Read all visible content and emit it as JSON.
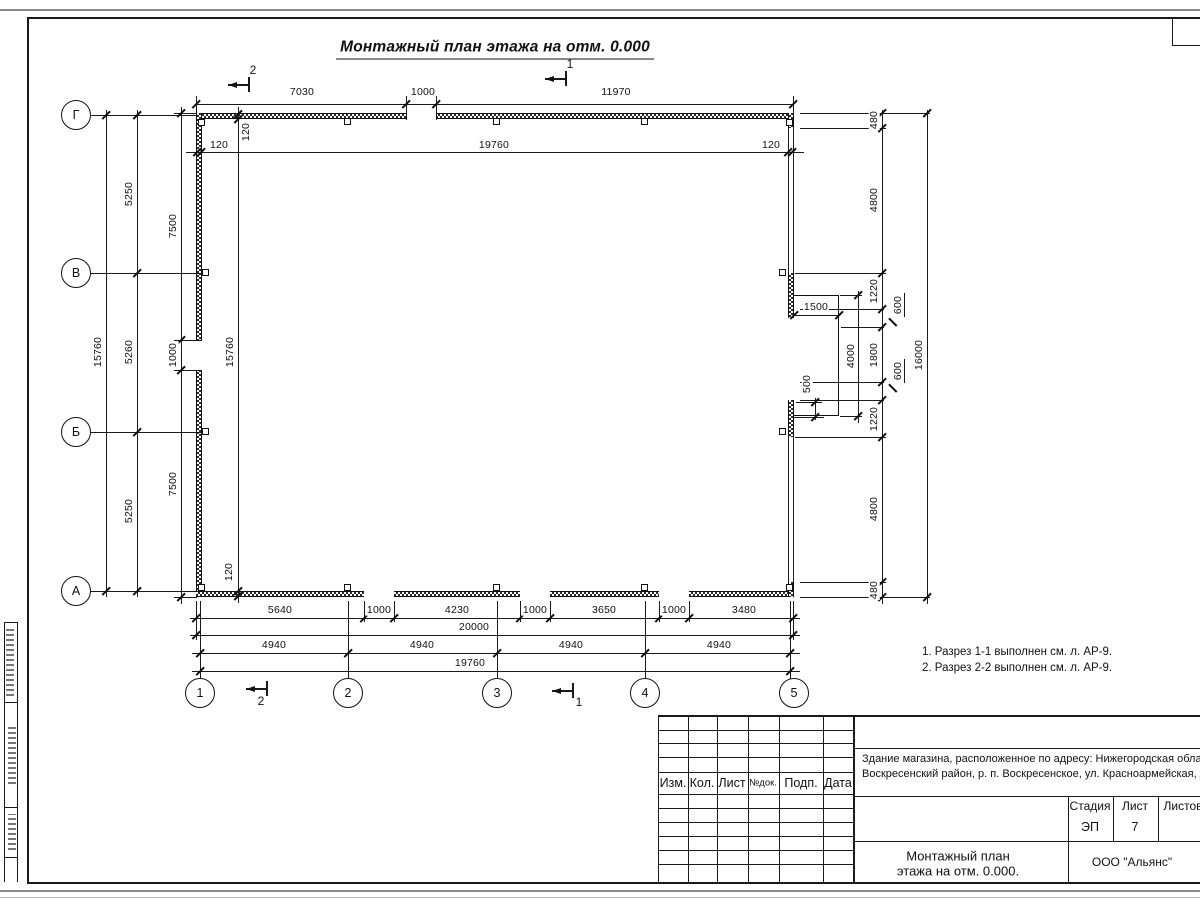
{
  "sheet_title": "Монтажный план этажа на отм. 0.000",
  "axis_labels": {
    "rows": [
      "Г",
      "В",
      "Б",
      "А"
    ],
    "cols": [
      "1",
      "2",
      "3",
      "4",
      "5"
    ]
  },
  "dimensions": [
    {
      "t": "7030",
      "x": 302,
      "y": 92,
      "r": 0
    },
    {
      "t": "1000",
      "x": 423,
      "y": 92,
      "r": 0
    },
    {
      "t": "11970",
      "x": 616,
      "y": 92,
      "r": 0
    },
    {
      "t": "120",
      "x": 219,
      "y": 145,
      "r": 0
    },
    {
      "t": "19760",
      "x": 494,
      "y": 145,
      "r": 0
    },
    {
      "t": "120",
      "x": 771,
      "y": 145,
      "r": 0
    },
    {
      "t": "120",
      "x": 246,
      "y": 132,
      "r": 1
    },
    {
      "t": "15760",
      "x": 230,
      "y": 352,
      "r": 1
    },
    {
      "t": "120",
      "x": 229,
      "y": 572,
      "r": 1
    },
    {
      "t": "15760",
      "x": 98,
      "y": 352,
      "r": 1
    },
    {
      "t": "5250",
      "x": 129,
      "y": 194,
      "r": 1
    },
    {
      "t": "5260",
      "x": 129,
      "y": 352,
      "r": 1
    },
    {
      "t": "5250",
      "x": 129,
      "y": 511,
      "r": 1
    },
    {
      "t": "7500",
      "x": 173,
      "y": 226,
      "r": 1
    },
    {
      "t": "1000",
      "x": 173,
      "y": 355,
      "r": 1
    },
    {
      "t": "7500",
      "x": 173,
      "y": 484,
      "r": 1
    },
    {
      "t": "5640",
      "x": 280,
      "y": 610,
      "r": 0
    },
    {
      "t": "1000",
      "x": 379,
      "y": 610,
      "r": 0
    },
    {
      "t": "4230",
      "x": 457,
      "y": 610,
      "r": 0
    },
    {
      "t": "1000",
      "x": 535,
      "y": 610,
      "r": 0
    },
    {
      "t": "3650",
      "x": 604,
      "y": 610,
      "r": 0
    },
    {
      "t": "1000",
      "x": 674,
      "y": 610,
      "r": 0
    },
    {
      "t": "3480",
      "x": 744,
      "y": 610,
      "r": 0
    },
    {
      "t": "20000",
      "x": 474,
      "y": 627,
      "r": 0
    },
    {
      "t": "4940",
      "x": 274,
      "y": 645,
      "r": 0
    },
    {
      "t": "4940",
      "x": 422,
      "y": 645,
      "r": 0
    },
    {
      "t": "4940",
      "x": 571,
      "y": 645,
      "r": 0
    },
    {
      "t": "4940",
      "x": 719,
      "y": 645,
      "r": 0
    },
    {
      "t": "19760",
      "x": 470,
      "y": 663,
      "r": 0
    },
    {
      "t": "1500",
      "x": 816,
      "y": 307,
      "r": 0
    },
    {
      "t": "4000",
      "x": 851,
      "y": 356,
      "r": 1
    },
    {
      "t": "500",
      "x": 807,
      "y": 384,
      "r": 1
    },
    {
      "t": "480",
      "x": 874,
      "y": 120,
      "r": 1
    },
    {
      "t": "4800",
      "x": 874,
      "y": 200,
      "r": 1
    },
    {
      "t": "1220",
      "x": 874,
      "y": 291,
      "r": 1
    },
    {
      "t": "1800",
      "x": 874,
      "y": 355,
      "r": 1
    },
    {
      "t": "1220",
      "x": 874,
      "y": 419,
      "r": 1
    },
    {
      "t": "4800",
      "x": 874,
      "y": 509,
      "r": 1
    },
    {
      "t": "480",
      "x": 874,
      "y": 590,
      "r": 1
    },
    {
      "t": "600",
      "x": 898,
      "y": 305,
      "r": 1
    },
    {
      "t": "600",
      "x": 898,
      "y": 371,
      "r": 1
    },
    {
      "t": "16000",
      "x": 919,
      "y": 355,
      "r": 1
    }
  ],
  "section_markers": [
    {
      "label": "2",
      "x": 228,
      "y": 84,
      "lx": 253,
      "ly": 70
    },
    {
      "label": "1",
      "x": 545,
      "y": 78,
      "lx": 570,
      "ly": 64
    },
    {
      "label": "2",
      "x": 246,
      "y": 688,
      "lx": 261,
      "ly": 701
    },
    {
      "label": "1",
      "x": 552,
      "y": 690,
      "lx": 579,
      "ly": 702
    }
  ],
  "notes": [
    "1. Разрез 1-1 выполнен см. л. АР-9.",
    "2. Разрез 2-2 выполнен см. л. АР-9."
  ],
  "title_block": {
    "revision_headers": [
      "Изм.",
      "Кол.",
      "Лист",
      "№док.",
      "Подп.",
      "Дата"
    ],
    "project_address_line1": "Здание магазина, расположенное по адресу: Нижегородская область,",
    "project_address_line2": "Воскресенский район, р. п. Воскресенское, ул. Красноармейская, д. 1",
    "stage_label": "Стадия",
    "sheet_label": "Лист",
    "sheets_label": "Листов",
    "stage_value": "ЭП",
    "sheet_value": "7",
    "doc_title_line1": "Монтажный план",
    "doc_title_line2": "этажа на отм. 0.000.",
    "company": "ООО \"Альянс\""
  }
}
